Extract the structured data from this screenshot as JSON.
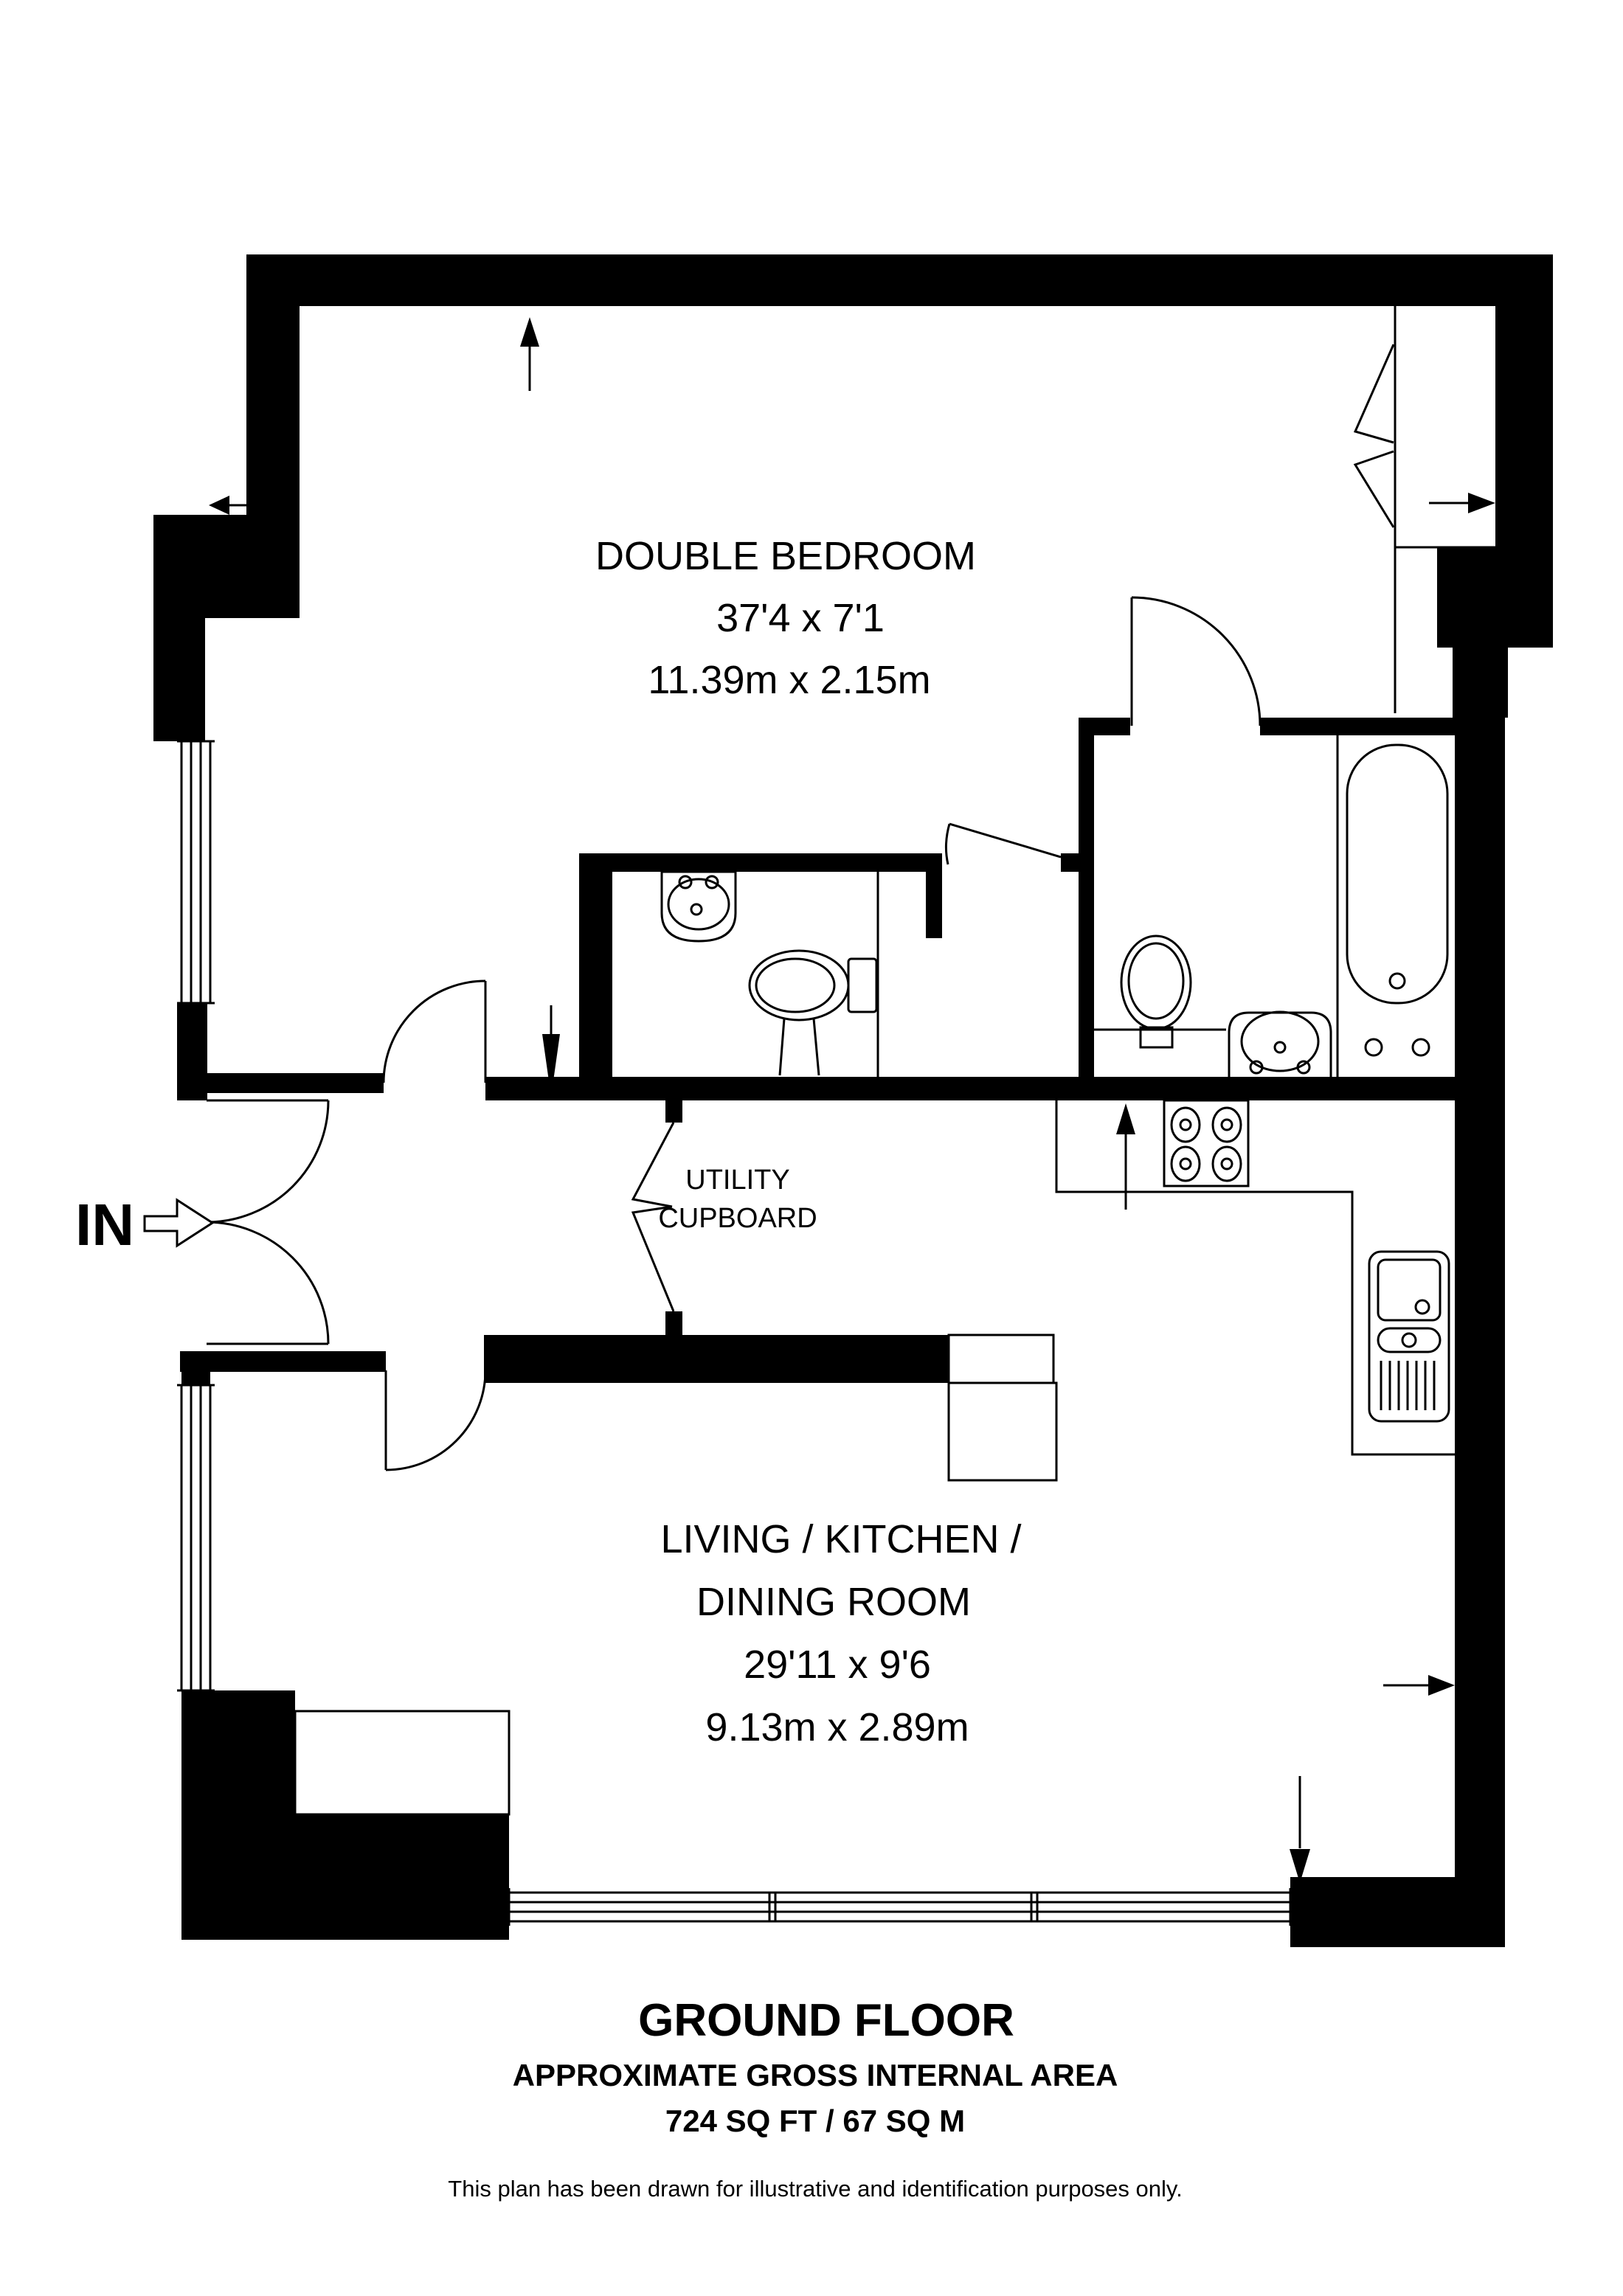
{
  "entry": {
    "label": "IN"
  },
  "bedroom": {
    "name": "DOUBLE BEDROOM",
    "dim_imperial": "37'4 x 7'1",
    "dim_metric": "11.39m x 2.15m"
  },
  "utility": {
    "line1": "UTILITY",
    "line2": "CUPBOARD"
  },
  "living": {
    "name_line1": "LIVING / KITCHEN /",
    "name_line2": "DINING ROOM",
    "dim_imperial": "29'11 x 9'6",
    "dim_metric": "9.13m x 2.89m"
  },
  "footer": {
    "floor_title": "GROUND FLOOR",
    "area_line1": "APPROXIMATE GROSS INTERNAL AREA",
    "area_line2": "724 SQ FT / 67 SQ M",
    "disclaimer": "This plan has been drawn for illustrative and identification purposes only."
  },
  "colors": {
    "wall": "#000000",
    "background": "#ffffff",
    "line": "#000000"
  }
}
